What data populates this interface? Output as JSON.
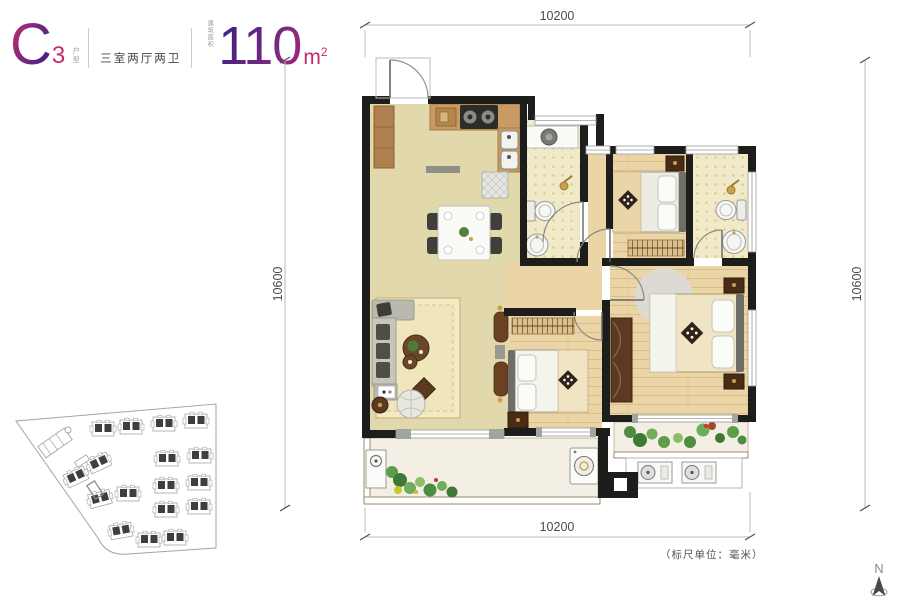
{
  "header": {
    "type_code": "C",
    "type_sub": "3",
    "type_label": "户型",
    "layout": "三室两厅两卫",
    "area_label": "建筑面积",
    "area_value": "110",
    "area_unit": "m",
    "area_sup": "2"
  },
  "dimensions": {
    "top": "10200",
    "bottom": "10200",
    "left": "10600",
    "right": "10600"
  },
  "note": "（标尺单位：毫米）",
  "compass": {
    "label": "N"
  },
  "colors": {
    "accent_magenta": "#c02a6e",
    "accent_purple": "#42217f",
    "wall": "#1d1d1b",
    "floor_main": "#e1d9ab",
    "floor_wood": "#ebd5a6",
    "floor_tile": "#f1eac9",
    "floor_balcony": "#f3efe4",
    "dim_text": "#4a4a4a"
  }
}
